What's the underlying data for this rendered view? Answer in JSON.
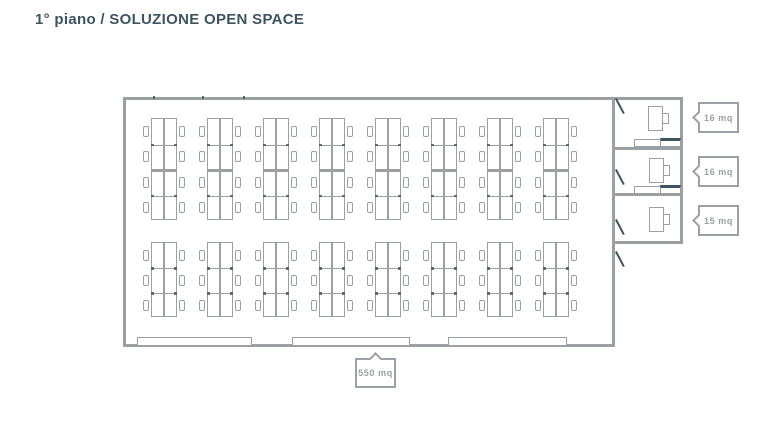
{
  "title": {
    "text": "1° piano / SOLUZIONE OPEN SPACE"
  },
  "colors": {
    "ink": "#3d5461",
    "wall_gray": "#9aa0a4",
    "label_gray": "#9b9fa2",
    "background": "#ffffff"
  },
  "floor_plan": {
    "open_space": {
      "area_label": "550 mq",
      "desk_groups": [
        {
          "position": "top",
          "clusters": 8,
          "desk_rows_per_cluster": 4,
          "desks_per_row": 2
        },
        {
          "position": "bottom",
          "clusters": 8,
          "desk_rows_per_cluster": 3,
          "desks_per_row": 2
        }
      ],
      "bottom_wall_windows": 3
    },
    "offices": [
      {
        "area_label": "16 mq",
        "furniture": [
          "desk",
          "chair",
          "cabinet"
        ]
      },
      {
        "area_label": "16 mq",
        "furniture": [
          "desk",
          "chair",
          "cabinet"
        ]
      },
      {
        "area_label": "15 mq",
        "furniture": [
          "desk",
          "chair"
        ]
      }
    ]
  }
}
